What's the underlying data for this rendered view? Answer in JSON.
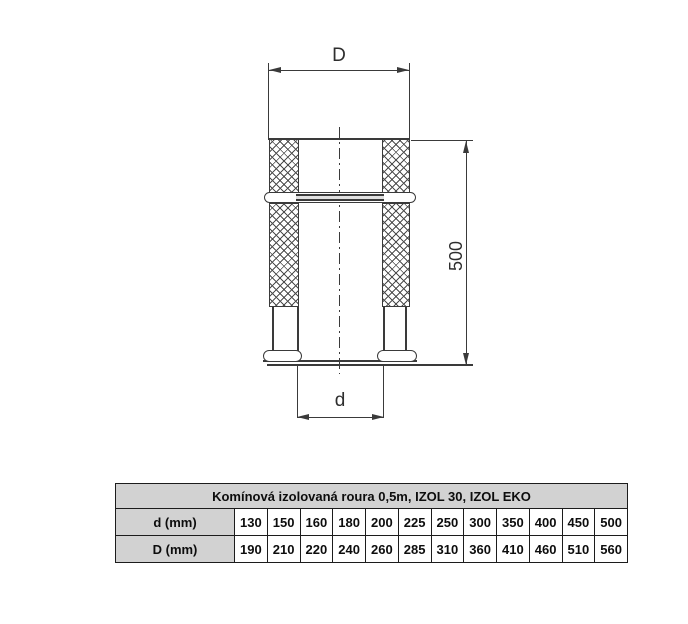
{
  "drawing": {
    "outer_diameter_label": "D",
    "inner_diameter_label": "d",
    "length_label": "500"
  },
  "table": {
    "title": "Komínová izolovaná roura 0,5m, IZOL 30, IZOL EKO",
    "row_inner": {
      "label": "d (mm)",
      "values": [
        "130",
        "150",
        "160",
        "180",
        "200",
        "225",
        "250",
        "300",
        "350",
        "400",
        "450",
        "500"
      ]
    },
    "row_outer": {
      "label": "D (mm)",
      "values": [
        "190",
        "210",
        "220",
        "240",
        "260",
        "285",
        "310",
        "360",
        "410",
        "460",
        "510",
        "560"
      ]
    }
  },
  "colors": {
    "line": "#3a3a3a",
    "table_header_bg": "#d2d2d2",
    "table_border": "#1c1c1c",
    "background": "#ffffff"
  }
}
